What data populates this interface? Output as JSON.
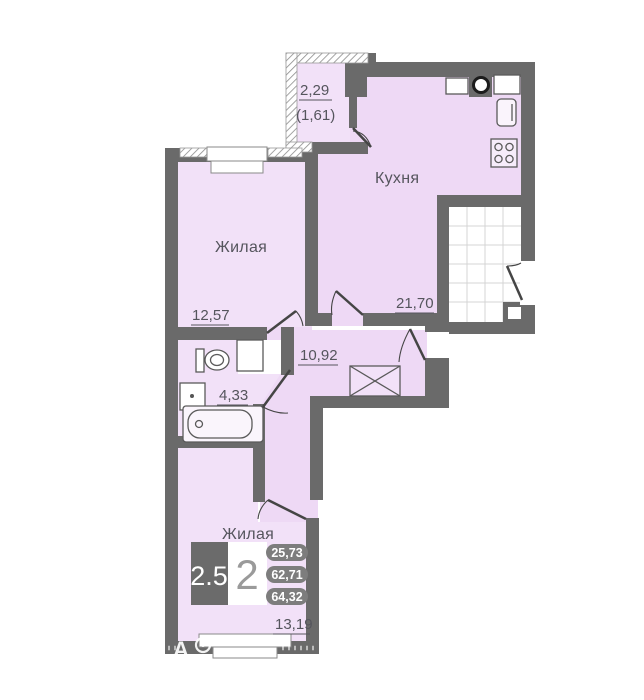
{
  "plan_labels": {
    "kitchen_name": "Кухня",
    "kitchen_area": "21,70",
    "living1_name": "Жилая",
    "living1_area": "12,57",
    "living2_name": "Жилая",
    "living2_area": "13,19",
    "bathroom_area": "4,33",
    "hallway_area": "10,92",
    "balcony_area": "2,29",
    "balcony_area_reduced": "(1,61)"
  },
  "summary_box": {
    "room_factor": "2.5",
    "room_count": "2",
    "badge_values": [
      "25,73",
      "62,71",
      "64,32"
    ]
  },
  "watermark": {
    "letter": "А"
  },
  "colors": {
    "wall": "#6a6a6a",
    "room_fill": "#f2e1f8",
    "kitchen_fill": "#eed9f5",
    "badge_fill": "#7d7d7d",
    "dimension_text": "#55555d"
  }
}
